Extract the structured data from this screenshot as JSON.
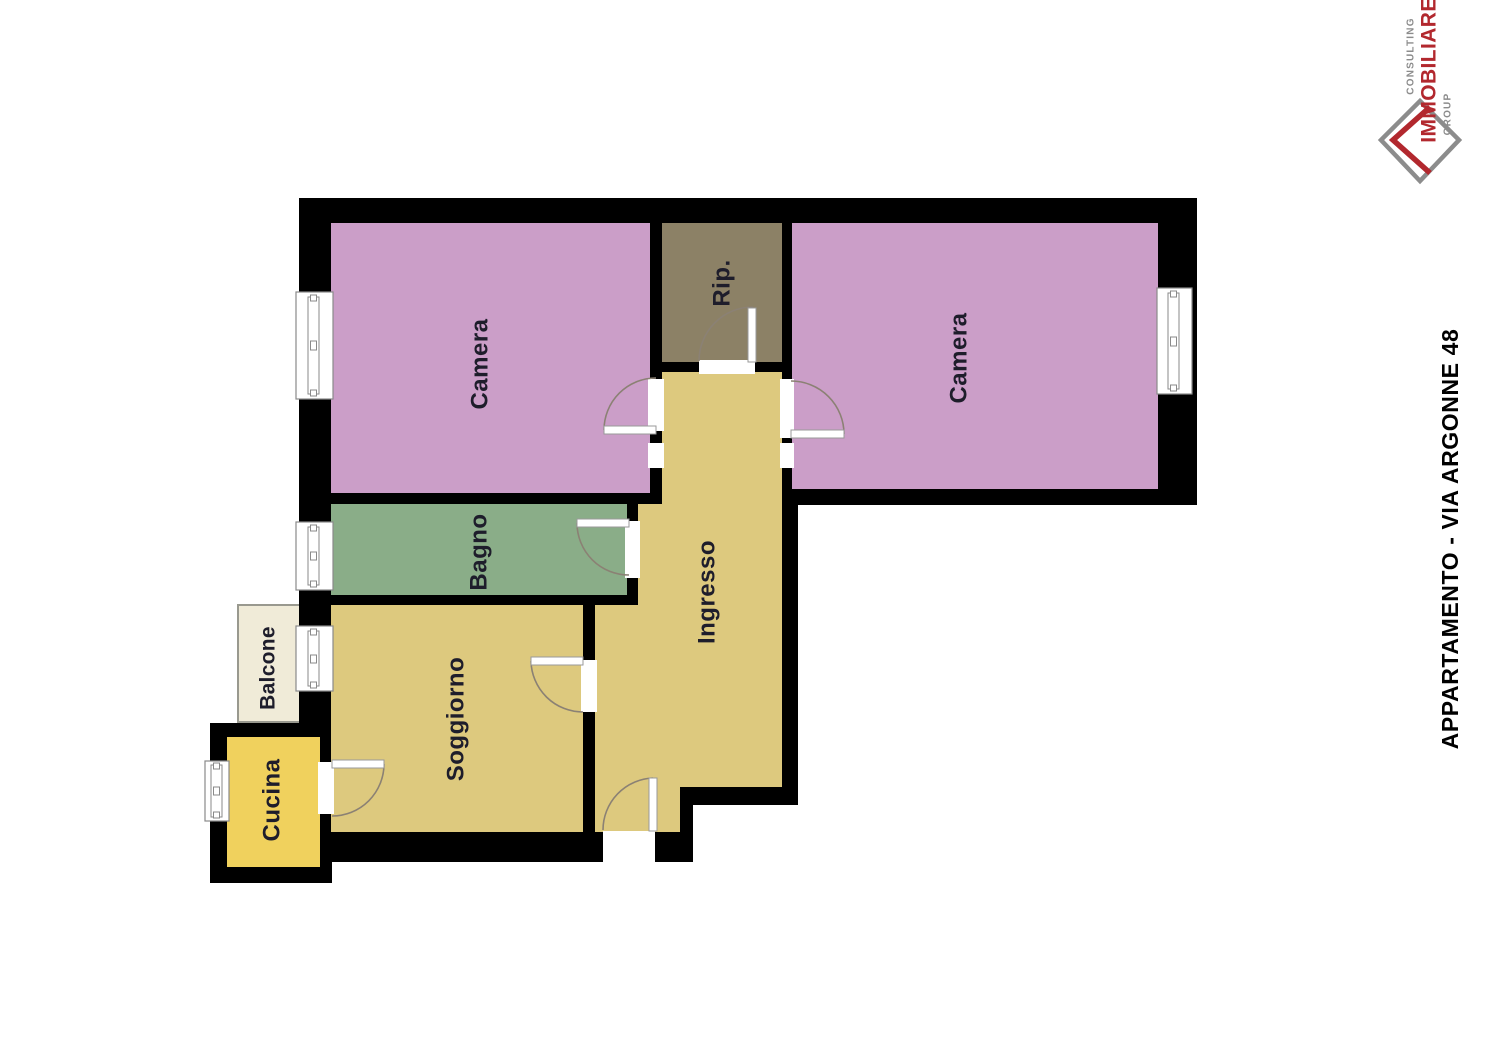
{
  "side_title": {
    "text": "APPARTAMENTO - VIA ARGONNE 48",
    "color": "#000000"
  },
  "logo": {
    "consulting": "CONSULTING",
    "immobiliare": "IMMOBILIARE",
    "group": "GROUP",
    "gray": "#8c8c8c",
    "red": "#b2282e"
  },
  "plan": {
    "background": "#ffffff",
    "wall_color": "#000000",
    "label_color": "#1e1d2b",
    "door_arc_color": "#8b8174",
    "window_frame_color": "#8a8a8a",
    "balcony_border_color": "#99998f",
    "rooms": [
      {
        "id": "camera-1",
        "label": "Camera",
        "color": "#cb9ec8"
      },
      {
        "id": "rip",
        "label": "Rip.",
        "color": "#8c8166"
      },
      {
        "id": "camera-2",
        "label": "Camera",
        "color": "#cb9ec8"
      },
      {
        "id": "bagno",
        "label": "Bagno",
        "color": "#8aad88"
      },
      {
        "id": "ingresso",
        "label": "Ingresso",
        "color": "#ddc97e"
      },
      {
        "id": "soggiorno",
        "label": "Soggiorno",
        "color": "#ddc97e"
      },
      {
        "id": "balcone",
        "label": "Balcone",
        "color": "#f0ebd8"
      },
      {
        "id": "cucina",
        "label": "Cucina",
        "color": "#f0d15d"
      }
    ]
  }
}
